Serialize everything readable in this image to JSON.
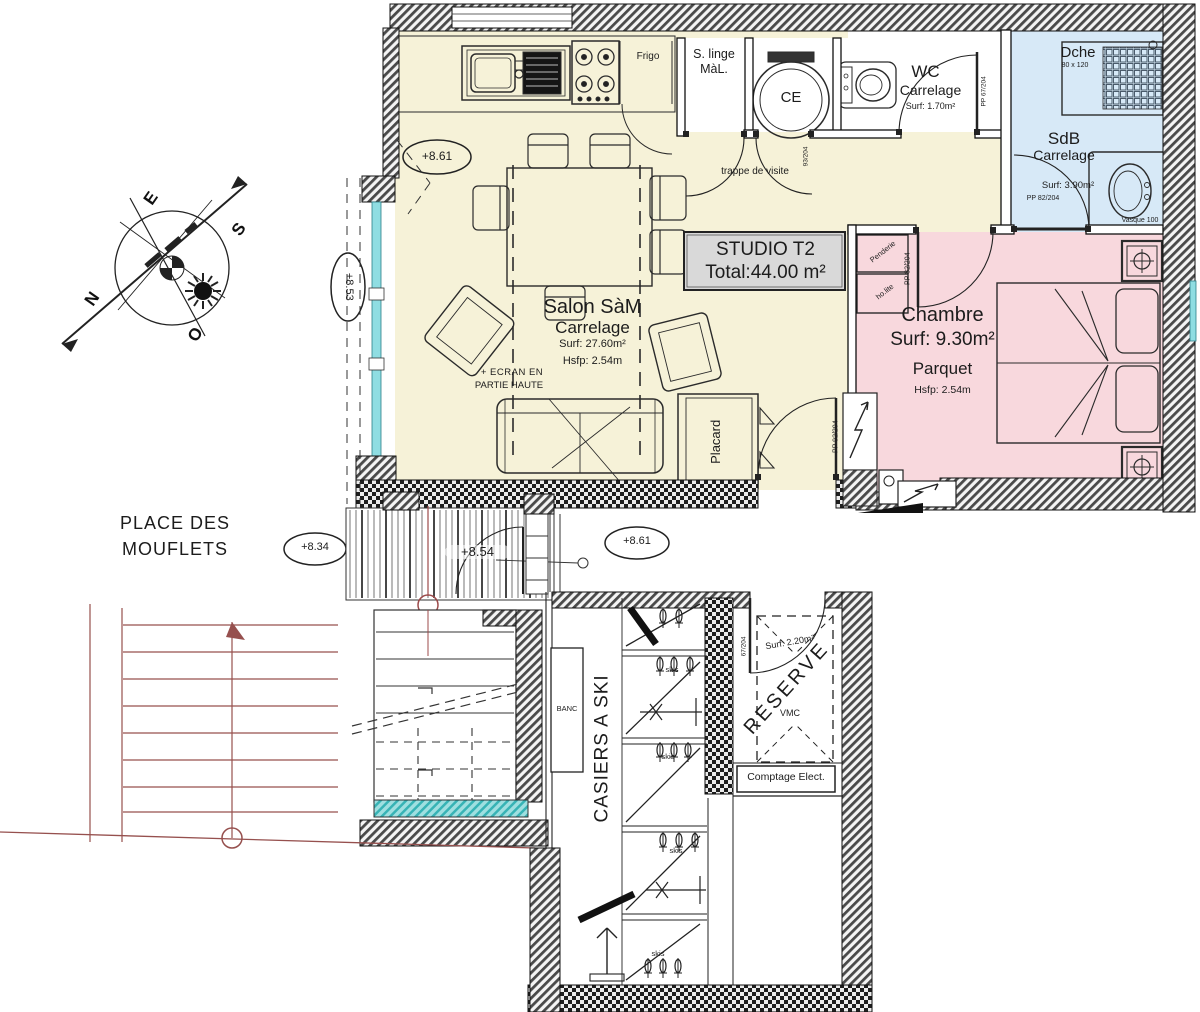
{
  "title_box": {
    "line1": "STUDIO T2",
    "line2": "Total:44.00 m²"
  },
  "rooms": {
    "salon": {
      "name": "Salon SàM",
      "floor": "Carrelage",
      "surface": "Surf: 27.60m²",
      "height": "Hsfp: 2.54m",
      "screen_note_line1": "+ ECRAN EN",
      "screen_note_line2": "PARTIE HAUTE"
    },
    "wc": {
      "name": "WC",
      "floor": "Carrelage",
      "surface": "Surf: 1.70m²",
      "door": "PP 67/204"
    },
    "sdb": {
      "name": "SdB",
      "floor": "Carrelage",
      "surface": "Surf: 3.90m²",
      "door": "PP 82/204",
      "shower": "Dche",
      "shower_size": "80 x 120",
      "sink": "Vasque 100"
    },
    "chambre": {
      "name": "Chambre",
      "surface": "Surf: 9.30m²",
      "floor": "Parquet",
      "height": "Hsfp: 2.54m",
      "door": "PP 82/204",
      "wardrobe_line1": "Penderie",
      "wardrobe_line2": "ho.lite"
    },
    "laundry": {
      "line1": "S. linge",
      "line2": "MàL."
    },
    "water_heater": "CE",
    "hall_door": "93/204",
    "entrance_door": "PP 92/204",
    "placard": "Placard",
    "reserve": {
      "name": "RESERVE",
      "surface": "Surf: 2.20m²",
      "vmc": "VMC",
      "door": "67/204"
    }
  },
  "labels": {
    "trappe": "trappe de visite",
    "frigo": "Frigo",
    "place_line1": "PLACE DES",
    "place_line2": "MOUFLETS",
    "banc": "BANC",
    "casiers": "CASIERS A SKI",
    "skis": "skis",
    "comptage": "Comptage Elect."
  },
  "elevations": {
    "kitchen": "+8.61",
    "balcony": "+8.53",
    "place": "+8.34",
    "grating": "+8.54",
    "landing": "+8.61"
  },
  "compass": {
    "n": "N",
    "s": "S",
    "e": "E",
    "o": "O"
  },
  "colors": {
    "salon": "#f6f2d8",
    "chambre": "#f8d8dd",
    "sdb": "#d7e9f7",
    "teal": "#9fdfe0",
    "stairs": "#96504e",
    "title_fill": "#d9d9d9",
    "glazing": "#8fdde2"
  }
}
